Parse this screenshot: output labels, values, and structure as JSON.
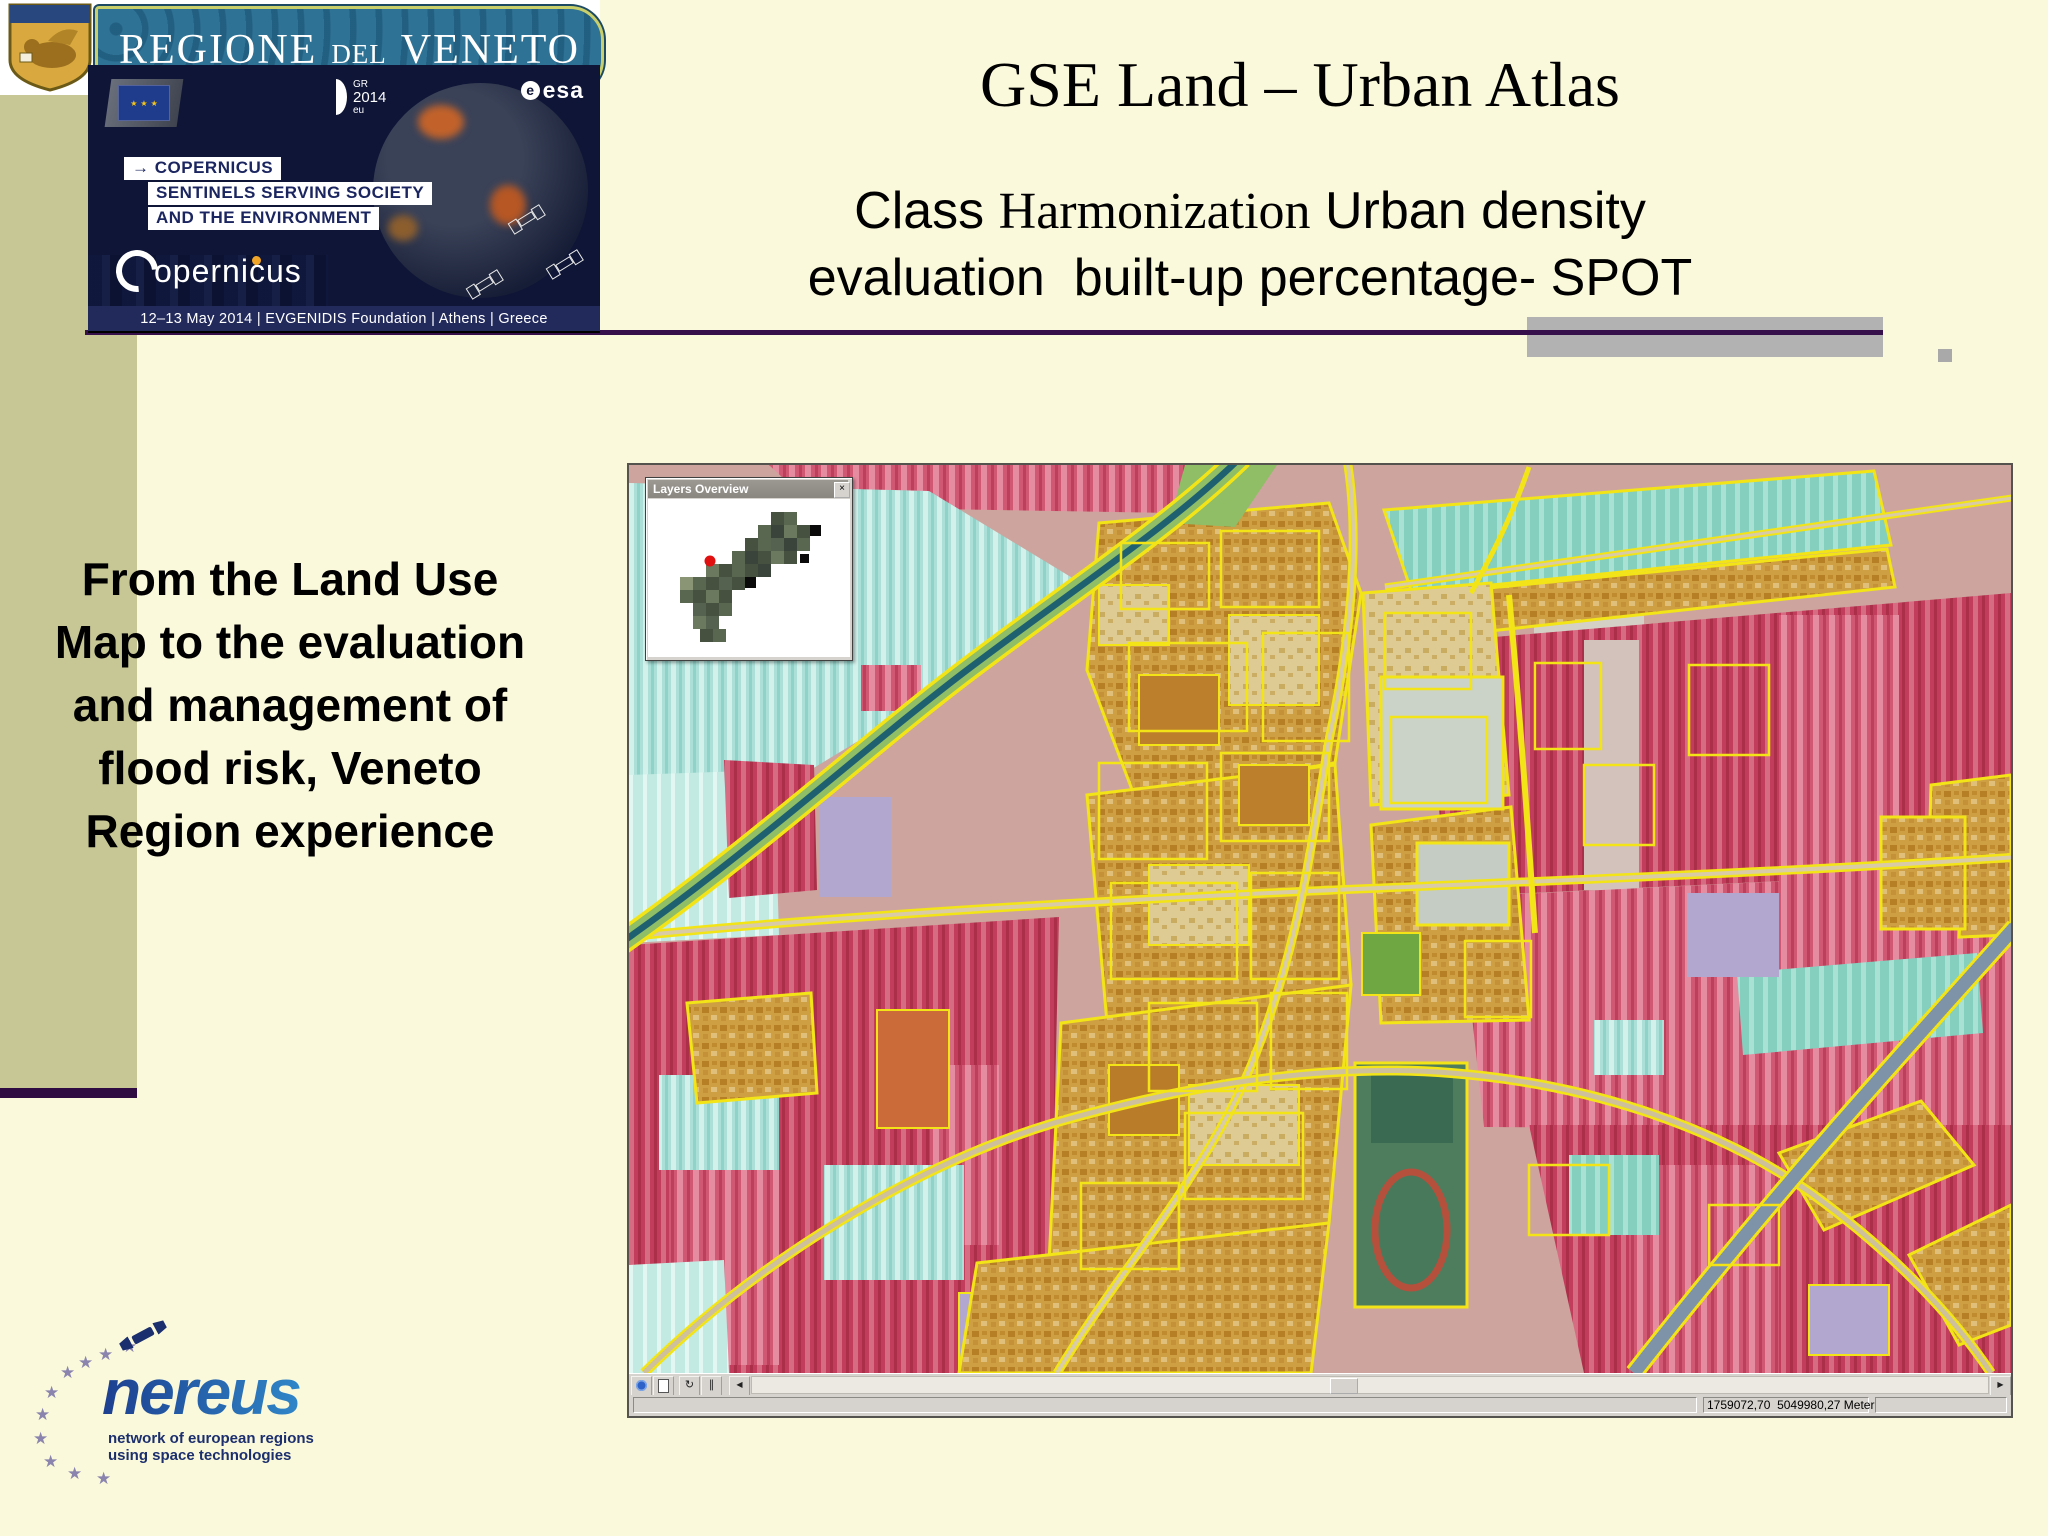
{
  "slide": {
    "title": "GSE Land – Urban Atlas",
    "subtitle_class": "Class ",
    "subtitle_harmonization": "Harmonization",
    "subtitle_urban_density": " Urban density",
    "subtitle_line2": "evaluation  built-up percentage- SPOT",
    "left_text_lines": [
      "From the Land Use",
      "Map to the evaluation",
      "and management of",
      "flood risk, Veneto",
      "Region experience"
    ]
  },
  "veneto_banner": {
    "word1": "REGIONE",
    "word2": "del",
    "word3": "VENETO"
  },
  "copernicus_banner": {
    "arrow": "→",
    "line1": "COPERNICUS",
    "line2": "SENTINELS SERVING SOCIETY",
    "line3": "AND THE ENVIRONMENT",
    "gr_line1": "GR",
    "gr_line2": "2014",
    "gr_line3": "eu",
    "esa_e": "e",
    "esa_word": "esa",
    "wordmark": "opernicus",
    "event_info": "12–13 May 2014 | EVGENIDIS Foundation | Athens | Greece"
  },
  "nereus_logo": {
    "wordmark": "nereus",
    "tagline1": "network of european regions",
    "tagline2": "using space technologies"
  },
  "gis_app": {
    "overview_window_title": "Layers Overview",
    "statusbar_coordinates": "1759072,70  5049980,27 Meter:"
  },
  "glyphs": {
    "star": "★",
    "close": "×",
    "refresh": "↻",
    "pause": "∥",
    "scroll_left": "◀",
    "scroll_right": "▶"
  },
  "colors": {
    "slide_background": "#FBF9DB",
    "left_band_olive": "#C7C795",
    "accent_line_purple": "#36104A",
    "gray_bar": "#B3B2B3",
    "parcel_outline_yellow": "#F2E417",
    "field_red": "#C23D5C",
    "field_cyan": "#ABDFD8",
    "urban_tan": "#CE9F43",
    "river_teal": "#1F6070",
    "banner_navy": "#0E1536",
    "nereus_blue": "#2566AE"
  }
}
